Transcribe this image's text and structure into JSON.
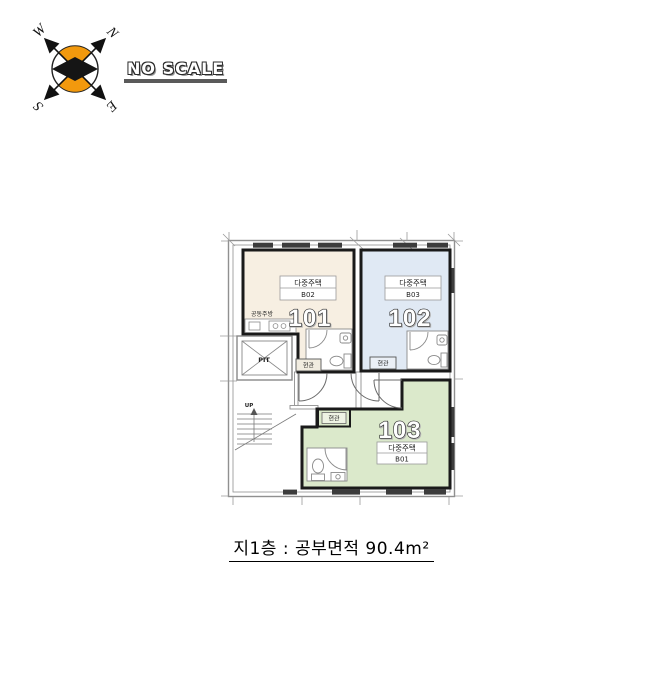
{
  "scale_note": "NO SCALE",
  "compass": {
    "north": "N",
    "east": "E",
    "south": "S",
    "west": "W"
  },
  "plan": {
    "units": [
      {
        "number": "101",
        "type": "다중주택",
        "code": "B02",
        "entrance": "현관",
        "kitchen": "공동주방",
        "fill": "#f7efe2"
      },
      {
        "number": "102",
        "type": "다중주택",
        "code": "B03",
        "entrance": "현관",
        "fill": "#e0e9f4"
      },
      {
        "number": "103",
        "type": "다중주택",
        "code": "B01",
        "entrance": "현관",
        "fill": "#dbe9cb"
      }
    ],
    "elevator": "PIT",
    "stairs": "UP"
  },
  "caption": "지1층 : 공부면적 90.4m²",
  "colors": {
    "unit_101_fill": "#f7efe2",
    "unit_102_fill": "#e0e9f4",
    "unit_103_fill": "#dbe9cb",
    "compass_orange": "#f2990d",
    "unit_border": "#1a1a1a",
    "wall_gray": "#909090"
  }
}
